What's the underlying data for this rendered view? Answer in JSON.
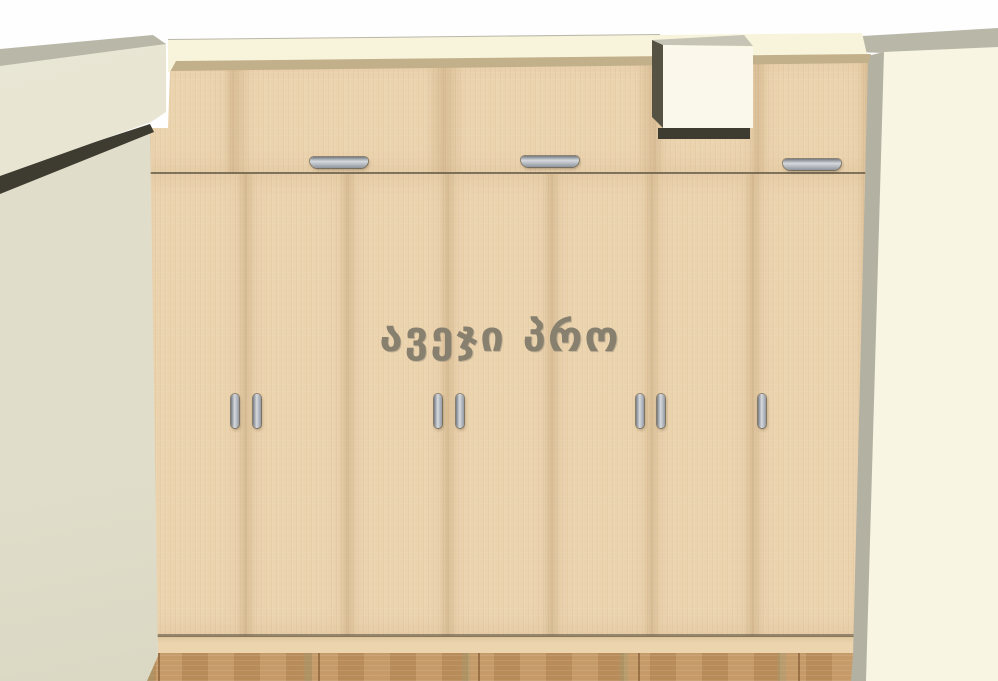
{
  "brand": {
    "text": "ავეჯი პრო"
  },
  "colors": {
    "brand_color": "#87806f",
    "ceiling_white": "#fefefe",
    "ceiling_gray": "#b9b7a8",
    "wall_band": "#f8f4dc",
    "wall_right": "#f8f5e2",
    "wall_right_shade": "#efecd6",
    "wall_left": "#e0deca",
    "beam_front": "#e2e0cd",
    "corner_shade": "#a7a597",
    "shadow_dark": "#3e3c30",
    "wardrobe_front": "#ebd3ae",
    "wardrobe_top": "#b9a67f",
    "wardrobe_plinth": "#ecd5ae",
    "box_front": "#fbf9ec",
    "box_side": "#555243",
    "box_top": "#c6c4b5",
    "handle_light": "#d6dade",
    "handle_dark": "#767c84",
    "floor_wood": "#cd9f72"
  }
}
